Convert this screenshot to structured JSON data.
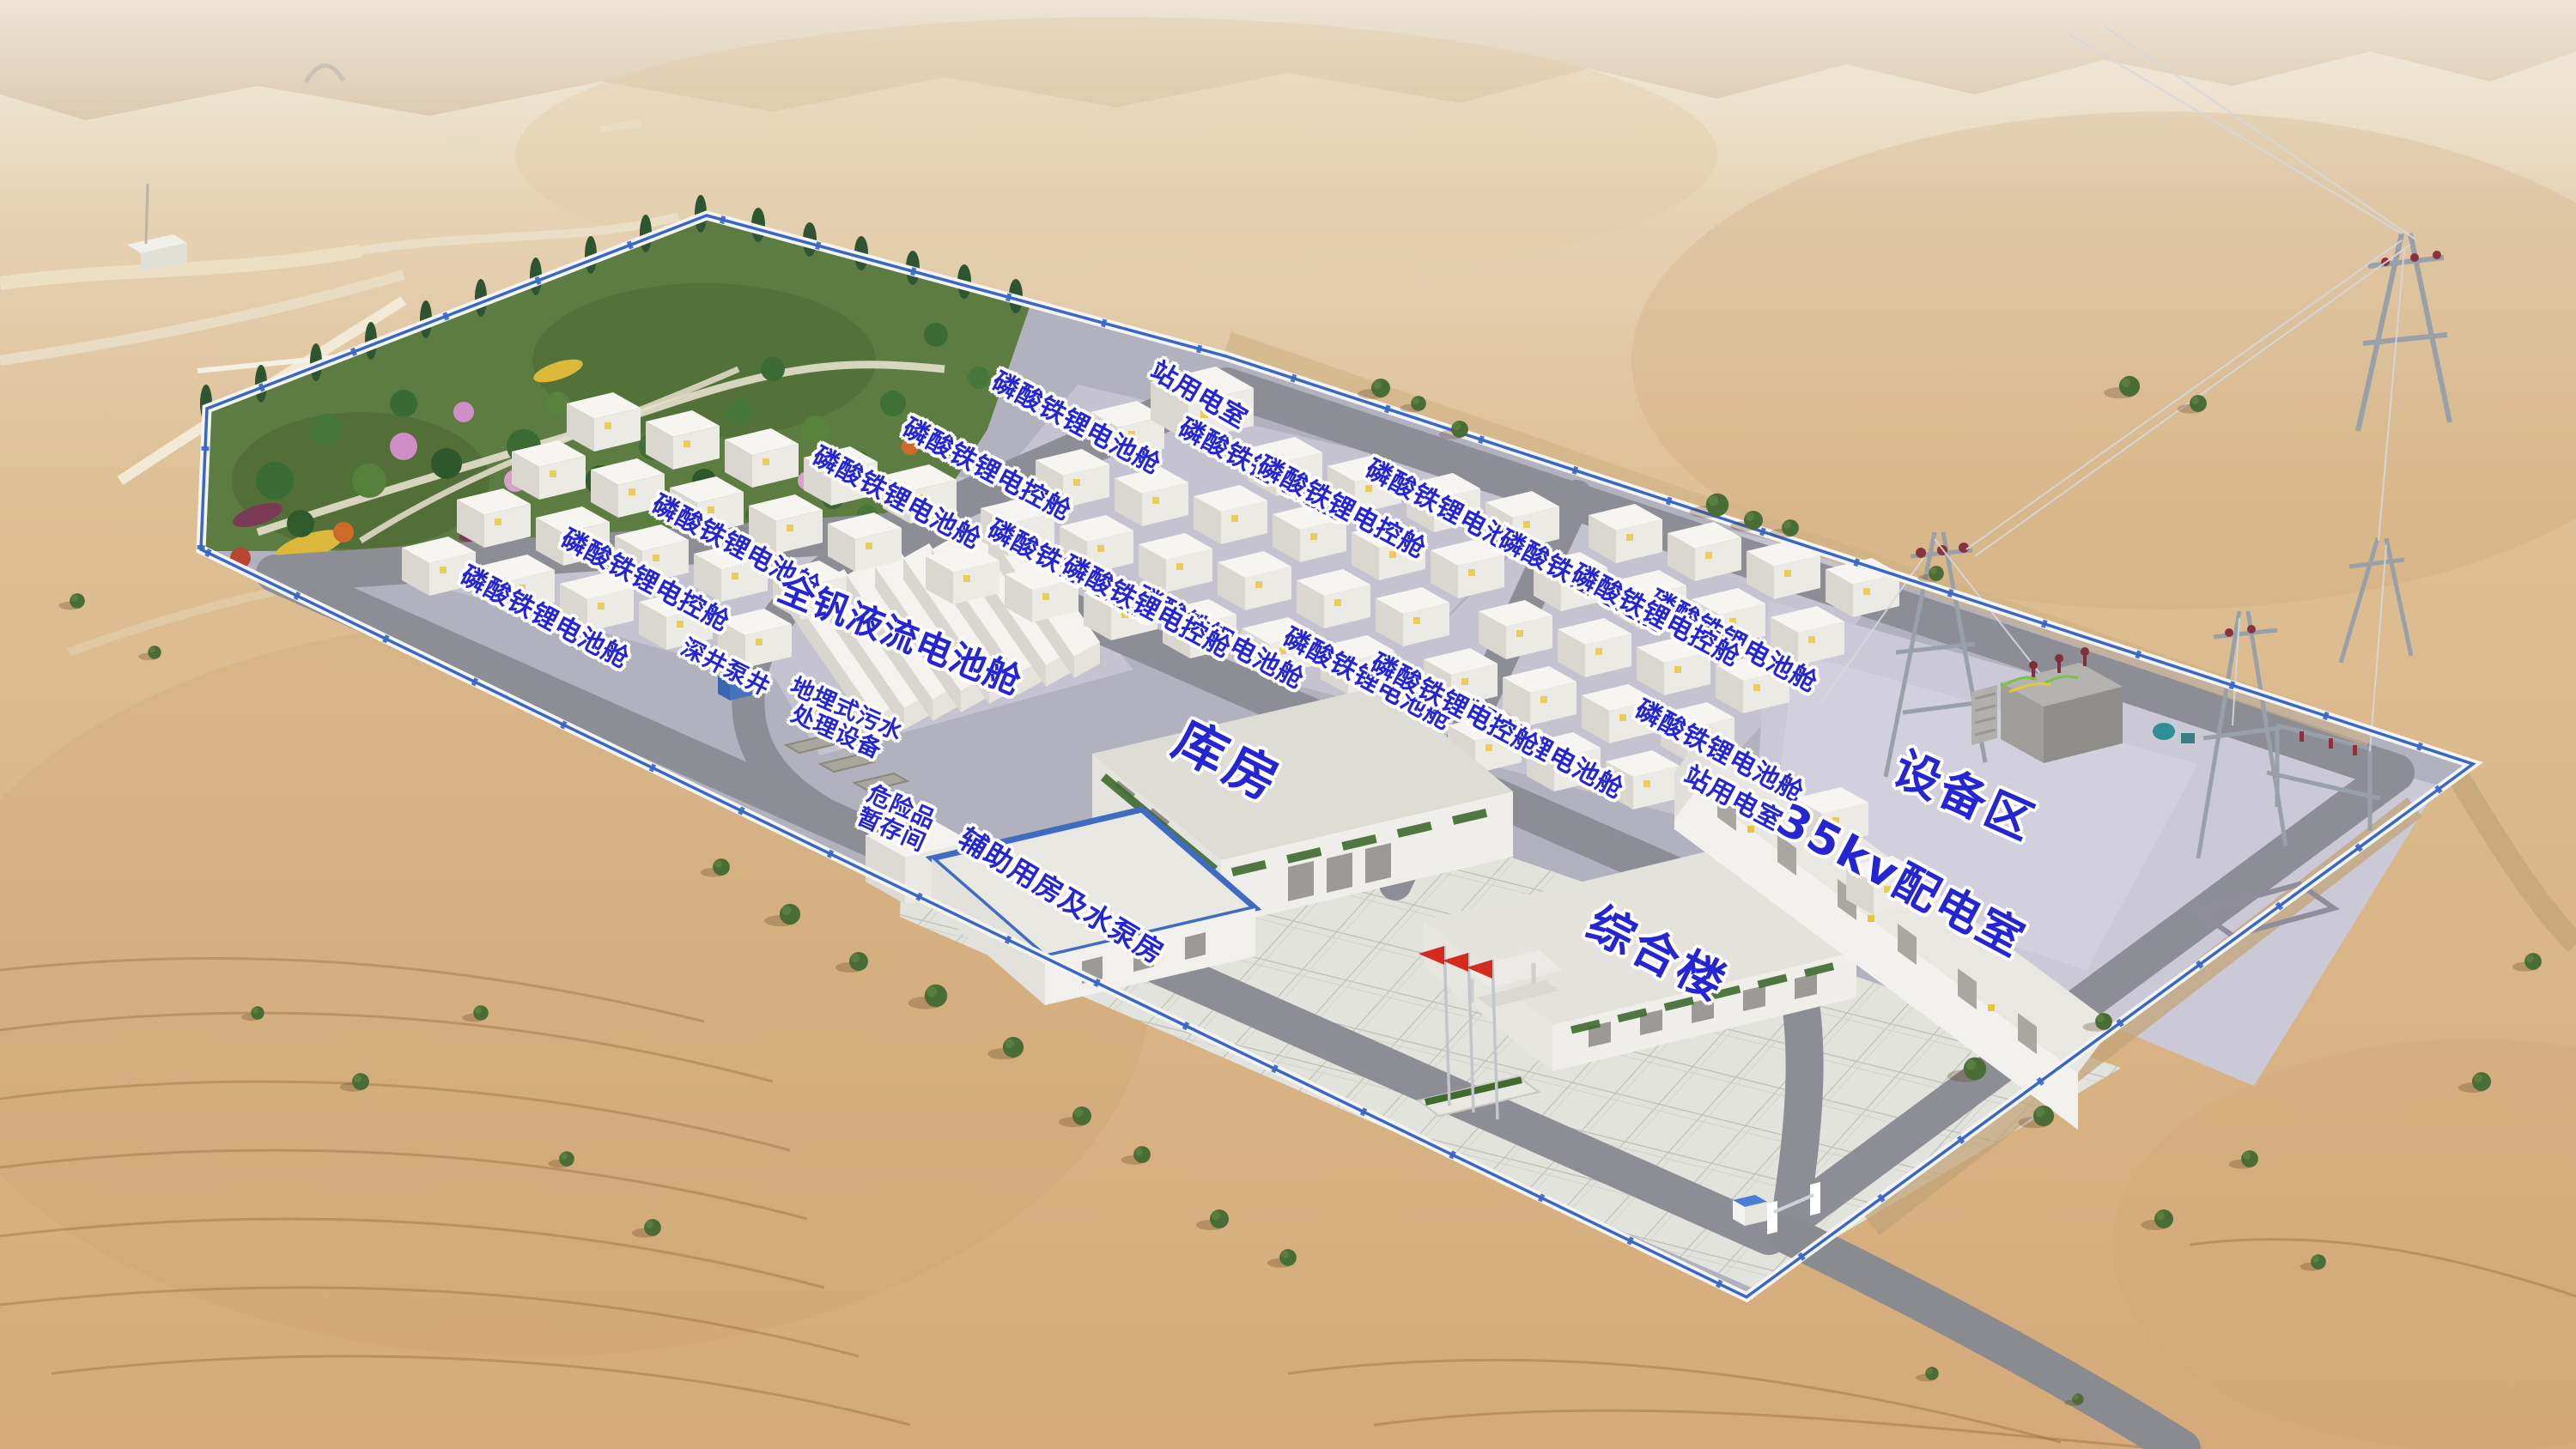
{
  "labels": {
    "lfp_battery_cabin": "磷酸铁锂电池舱",
    "lfp_control_cabin": "磷酸铁锂电控舱",
    "vanadium_flow_cabin": "全钒液流电池舱",
    "station_power_room": "站用电室",
    "deep_well_pump": "深井泵井",
    "buried_sewage_line1": "地埋式污水",
    "buried_sewage_line2": "处理设备",
    "hazmat_line1": "危险品",
    "hazmat_line2": "暂存间",
    "auxiliary_pump_house": "辅助用房及水泵房",
    "warehouse": "库房",
    "comprehensive_building": "综合楼",
    "distribution_room_35kv": "35kv配电室",
    "equipment_area": "设备区"
  },
  "colors": {
    "label_text": "#2525d4",
    "label_outline": "#ffffff",
    "fence_blue": "#3a67c4",
    "roof_trim_blue": "#4a7fd4",
    "building_white": "#f2f1ed",
    "pavement_gray": "#b2b2be",
    "road_gray": "#8d8e95",
    "apron_concrete": "#e3e3dd",
    "gravel_pad": "#ccc9d7",
    "desert_sand": "#dcbd92",
    "park_green": "#5d7c42",
    "flag_red": "#d42b1e"
  }
}
